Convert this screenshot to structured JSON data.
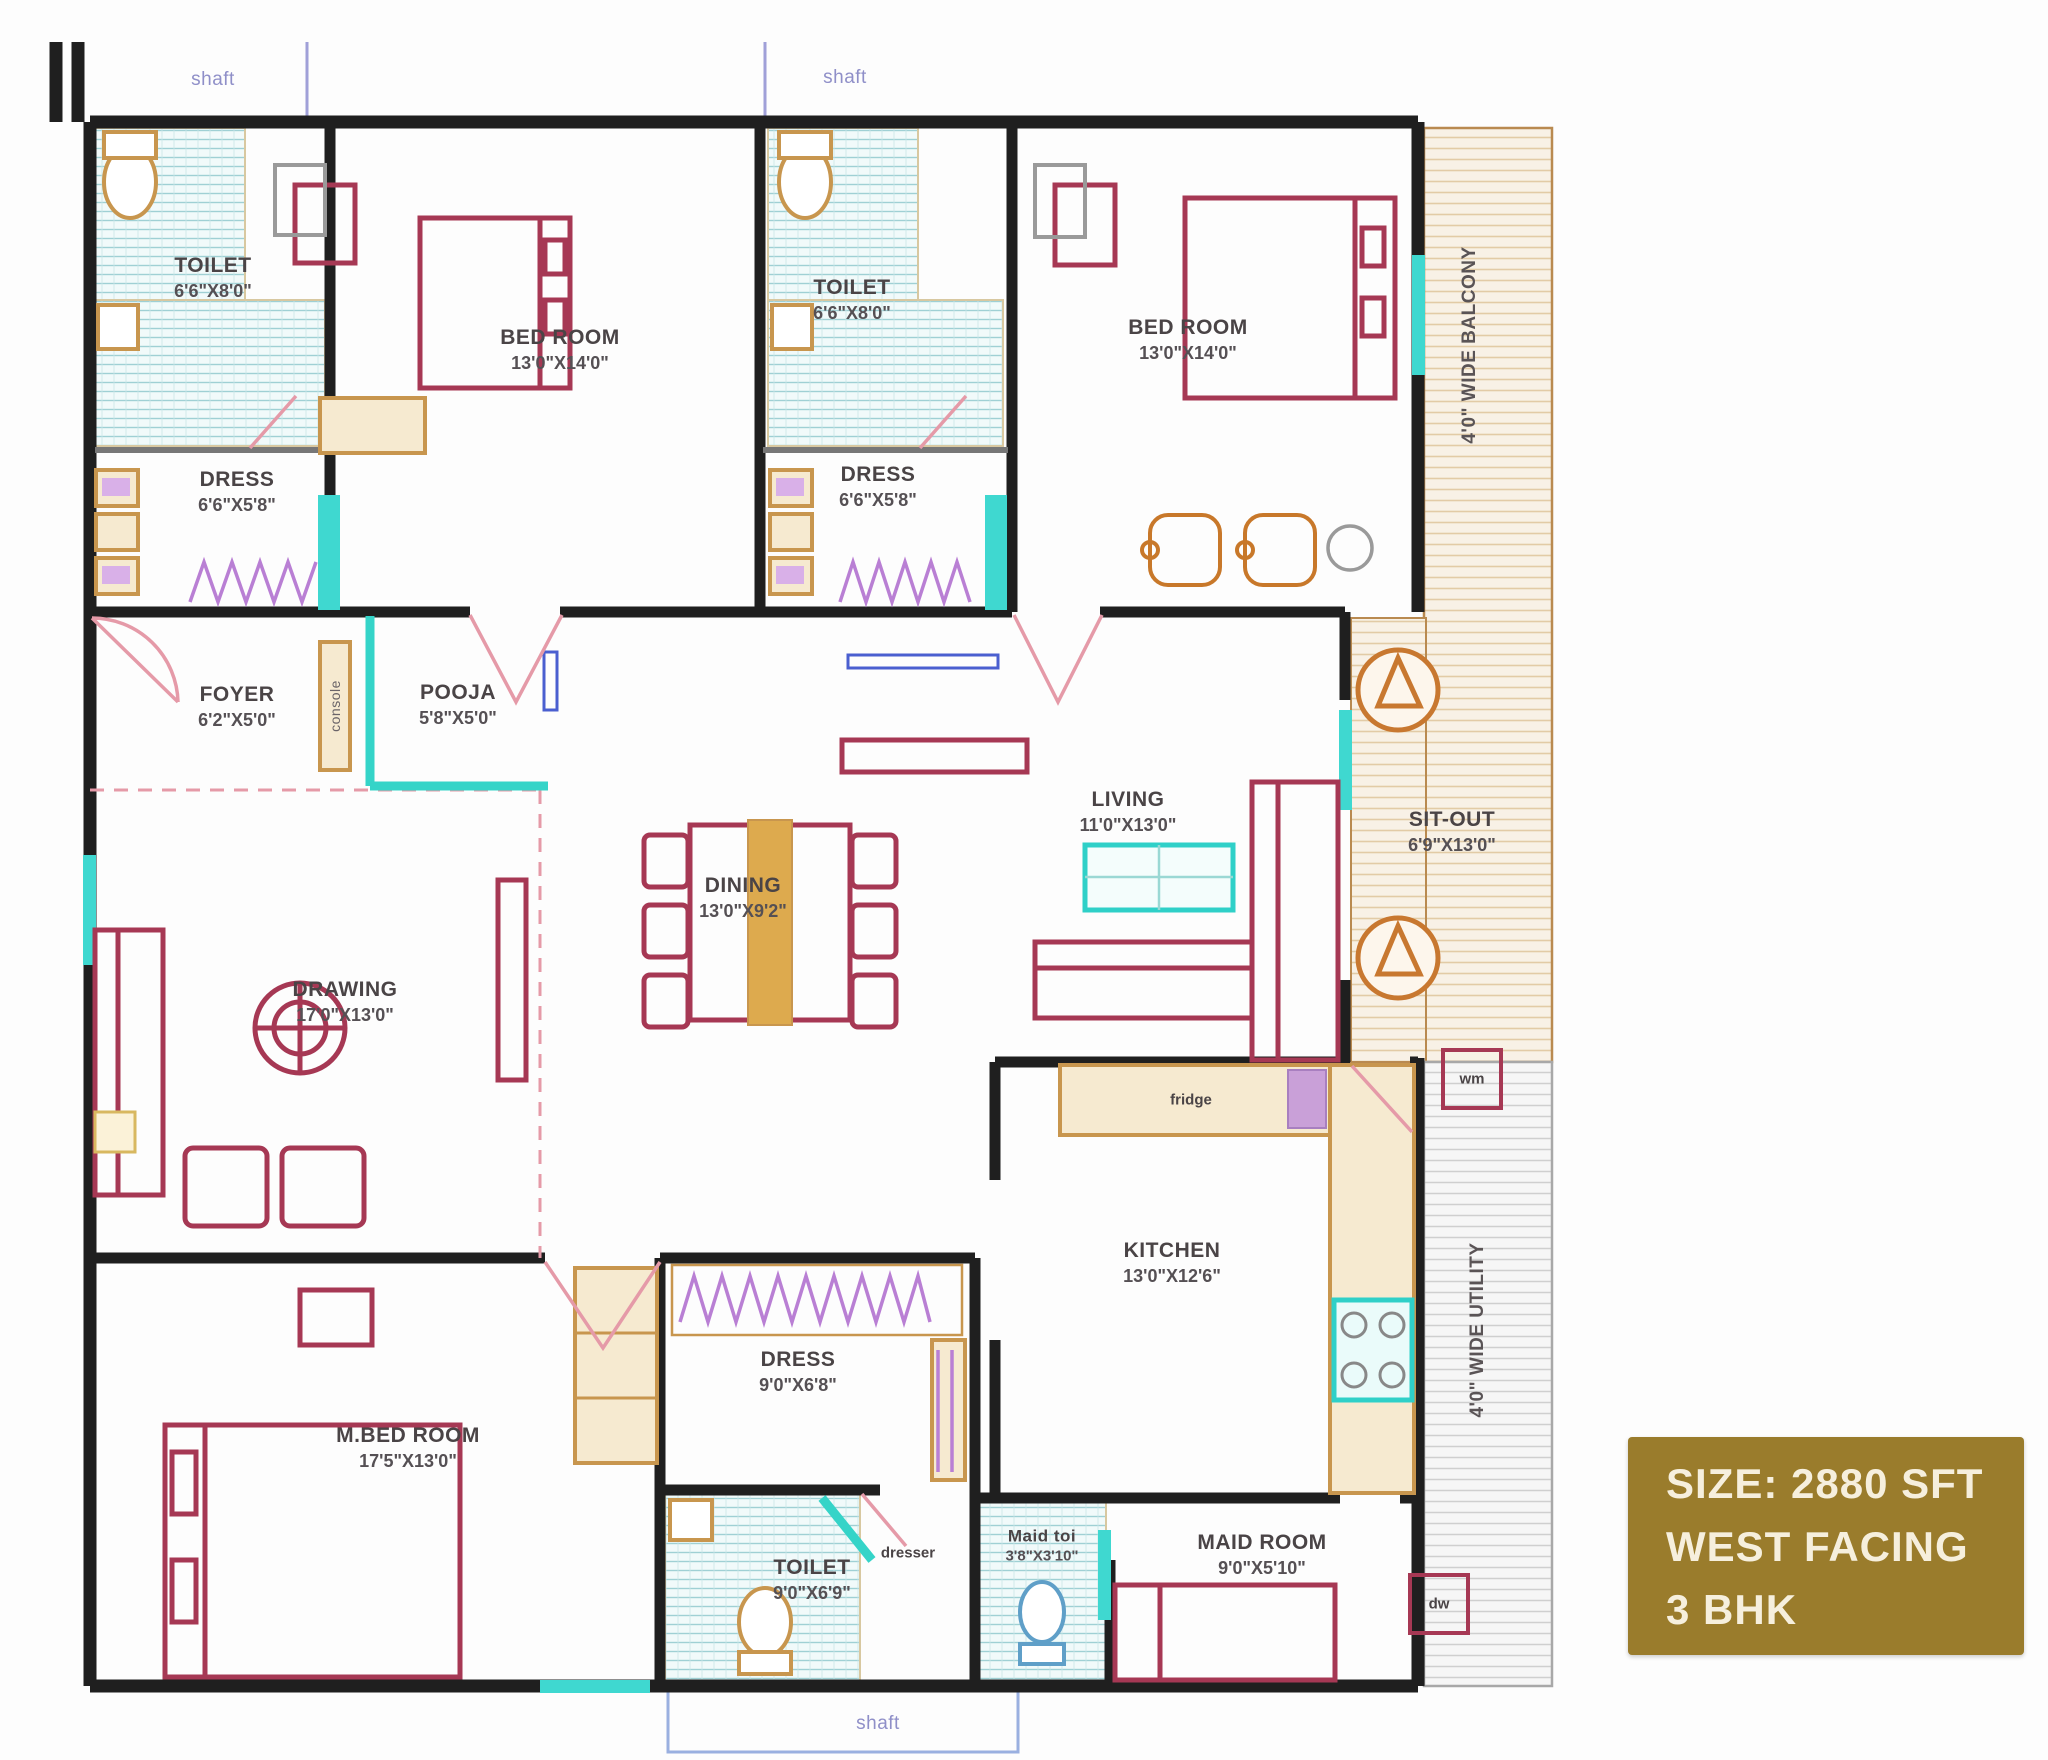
{
  "info_box": {
    "line1": "SIZE: 2880 SFT",
    "line2": "WEST FACING",
    "line3": "3 BHK",
    "bg_color": "#9a7c2c"
  },
  "rooms": [
    {
      "name": "TOILET",
      "dims": "6'6\"X8'0\""
    },
    {
      "name": "BED ROOM",
      "dims": "13'0\"X14'0\""
    },
    {
      "name": "TOILET",
      "dims": "6'6\"X8'0\""
    },
    {
      "name": "BED ROOM",
      "dims": "13'0\"X14'0\""
    },
    {
      "name": "DRESS",
      "dims": "6'6\"X5'8\""
    },
    {
      "name": "DRESS",
      "dims": "6'6\"X5'8\""
    },
    {
      "name": "FOYER",
      "dims": "6'2\"X5'0\""
    },
    {
      "name": "POOJA",
      "dims": "5'8\"X5'0\""
    },
    {
      "name": "DINING",
      "dims": "13'0\"X9'2\""
    },
    {
      "name": "DRAWING",
      "dims": "17'0\"X13'0\""
    },
    {
      "name": "LIVING",
      "dims": "11'0\"X13'0\""
    },
    {
      "name": "SIT-OUT",
      "dims": "6'9\"X13'0\""
    },
    {
      "name": "KITCHEN",
      "dims": "13'0\"X12'6\""
    },
    {
      "name": "M.BED ROOM",
      "dims": "17'5\"X13'0\""
    },
    {
      "name": "DRESS",
      "dims": "9'0\"X6'8\""
    },
    {
      "name": "TOILET",
      "dims": "9'0\"X6'9\""
    },
    {
      "name": "Maid toi",
      "dims": "3'8\"X3'10\""
    },
    {
      "name": "MAID ROOM",
      "dims": "9'0\"X5'10\""
    }
  ],
  "annotations": {
    "balcony": "4'0\" WIDE BALCONY",
    "utility": "4'0\" WIDE UTILITY",
    "shaft": "shaft",
    "console": "console",
    "dresser": "dresser",
    "fridge": "fridge",
    "wm": "wm",
    "dw": "dw"
  },
  "colors": {
    "accent_gold": "#9a7c2c",
    "wall_black": "#1f1f1f",
    "furniture_red": "#a63854",
    "turquoise": "#35d4c8",
    "toilet_hatch_teal": "#9fd0d4",
    "balcony_hatch_tan": "#e2cba6",
    "shaft_text_purple": "#8f8fc8"
  }
}
